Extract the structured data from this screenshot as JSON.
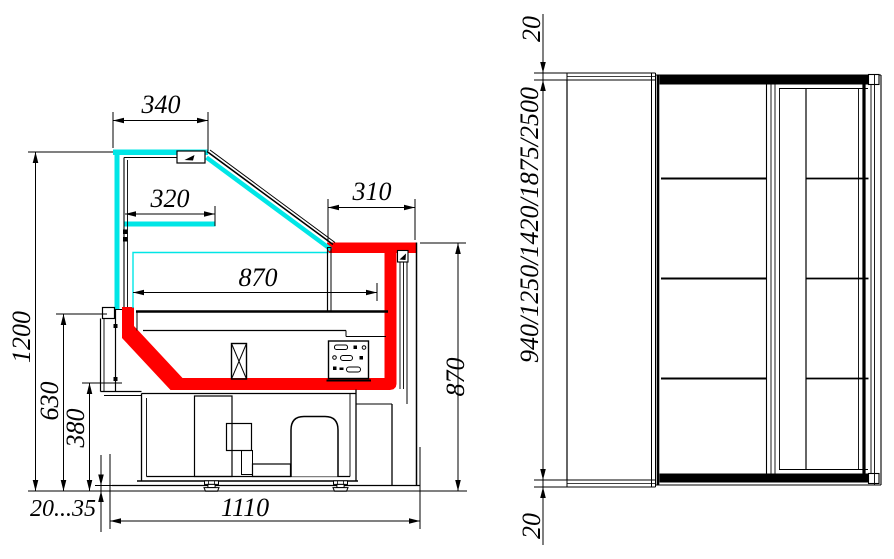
{
  "colors": {
    "red": "#FF0000",
    "cyan": "#00E6E6",
    "ink": "#000000",
    "paper": "#FFFFFF"
  },
  "section_view": {
    "dims": {
      "canopy_depth": "340",
      "shelf_depth": "320",
      "worktop_depth": "310",
      "display_depth": "870",
      "overall_height": "1200",
      "front_height": "630",
      "deck_height": "380",
      "foot_adjust_range": "20...35",
      "base_depth": "1110",
      "worktop_height": "870"
    }
  },
  "plan_view": {
    "dims": {
      "top_overhang": "20",
      "length_options": "940/1250/1420/1875/2500",
      "bottom_overhang": "20"
    }
  }
}
